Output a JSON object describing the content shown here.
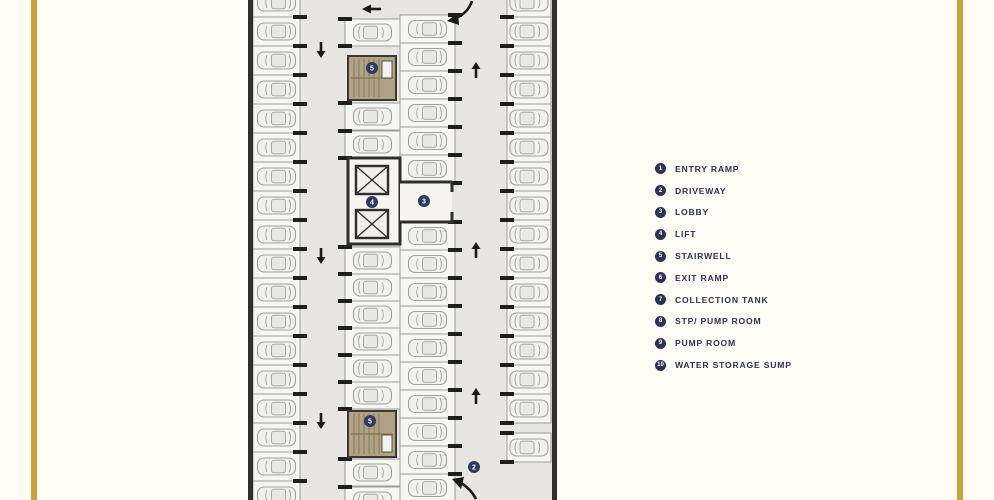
{
  "page": {
    "background": "#FFFCF5",
    "accent_bar_color": "#C8A33D"
  },
  "plan": {
    "colors": {
      "floor": "#E7E6E3",
      "wall": "#2E2E2C",
      "stall_fill": "#F6F6F3",
      "stall_stroke": "#9C9C98",
      "car_fill": "#F1F1ED",
      "car_stroke": "#A2A29C",
      "cabin_fill": "#E9E8E2",
      "tick": "#1E1E1E",
      "stair_fill": "#B1A286",
      "stair_line": "#8A7A5C",
      "stair_stroke": "#3A382F",
      "lobby_fill": "#F6F5F1",
      "lift_fill": "#F0EFEA",
      "arrow": "#1A1A1A",
      "marker": "#2E3B60"
    },
    "markers": [
      {
        "number": "5",
        "name": "stairwell-top-marker",
        "x": 124,
        "y": 68
      },
      {
        "number": "4",
        "name": "lift-marker",
        "x": 124,
        "y": 202
      },
      {
        "number": "3",
        "name": "lobby-marker",
        "x": 176,
        "y": 201
      },
      {
        "number": "5",
        "name": "stairwell-bottom-marker",
        "x": 122,
        "y": 421
      },
      {
        "number": "2",
        "name": "driveway-marker",
        "x": 226,
        "y": 467
      }
    ]
  },
  "legend": {
    "badge_color": "#2B3454",
    "text_color": "#2B3454",
    "items": [
      {
        "number": "1",
        "label": "ENTRY RAMP"
      },
      {
        "number": "2",
        "label": "DRIVEWAY"
      },
      {
        "number": "3",
        "label": "LOBBY"
      },
      {
        "number": "4",
        "label": "LIFT"
      },
      {
        "number": "5",
        "label": "STAIRWELL"
      },
      {
        "number": "6",
        "label": "EXIT RAMP"
      },
      {
        "number": "7",
        "label": "COLLECTION TANK"
      },
      {
        "number": "8",
        "label": "STP/ PUMP ROOM"
      },
      {
        "number": "9",
        "label": "PUMP ROOM"
      },
      {
        "number": "10",
        "label": "WATER STORAGE SUMP"
      }
    ]
  }
}
